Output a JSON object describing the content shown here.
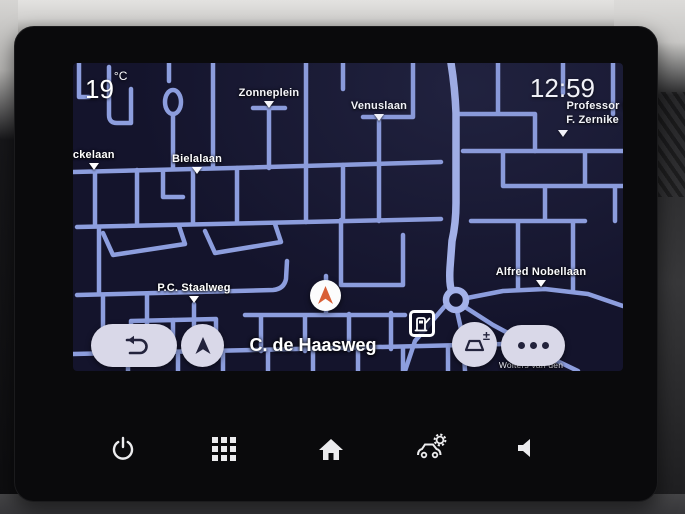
{
  "app": {
    "name": "car-navigation-display"
  },
  "statusbar": {
    "temperature": "19",
    "temperature_unit": "°C",
    "time": "12:59"
  },
  "map": {
    "current_street": "C. de Haasweg",
    "streets": {
      "zonneplein": "Zonneplein",
      "venuslaan": "Venuslaan",
      "nckelaan": "nckelaan",
      "bielalaan": "Bielalaan",
      "pc_staalweg": "P.C. Staalweg",
      "alfred_nobellaan": "Alfred Nobellaan",
      "professor_d": "Professor D",
      "f_zernike": "F. Zernike",
      "wolters": "Wolters van den"
    },
    "poi": {
      "fuel_station": "fuel-station"
    }
  },
  "controls": {
    "zoom_symbol": "±",
    "more_glyph": "•••",
    "back": "back",
    "recenter": "recenter"
  },
  "hardware_bar": {
    "buttons": [
      "power",
      "apps",
      "home",
      "vehicle-settings",
      "volume"
    ]
  },
  "colors": {
    "map_background": "#14142c",
    "road": "#8d9ede",
    "main_road": "#a5b3ea",
    "button_background": "#d9d8e8",
    "button_glyph": "#23233c",
    "marker_arrow": "#d95f35",
    "dashboard_light": "#d2d1cf",
    "bezel": "#0a0a0c"
  }
}
